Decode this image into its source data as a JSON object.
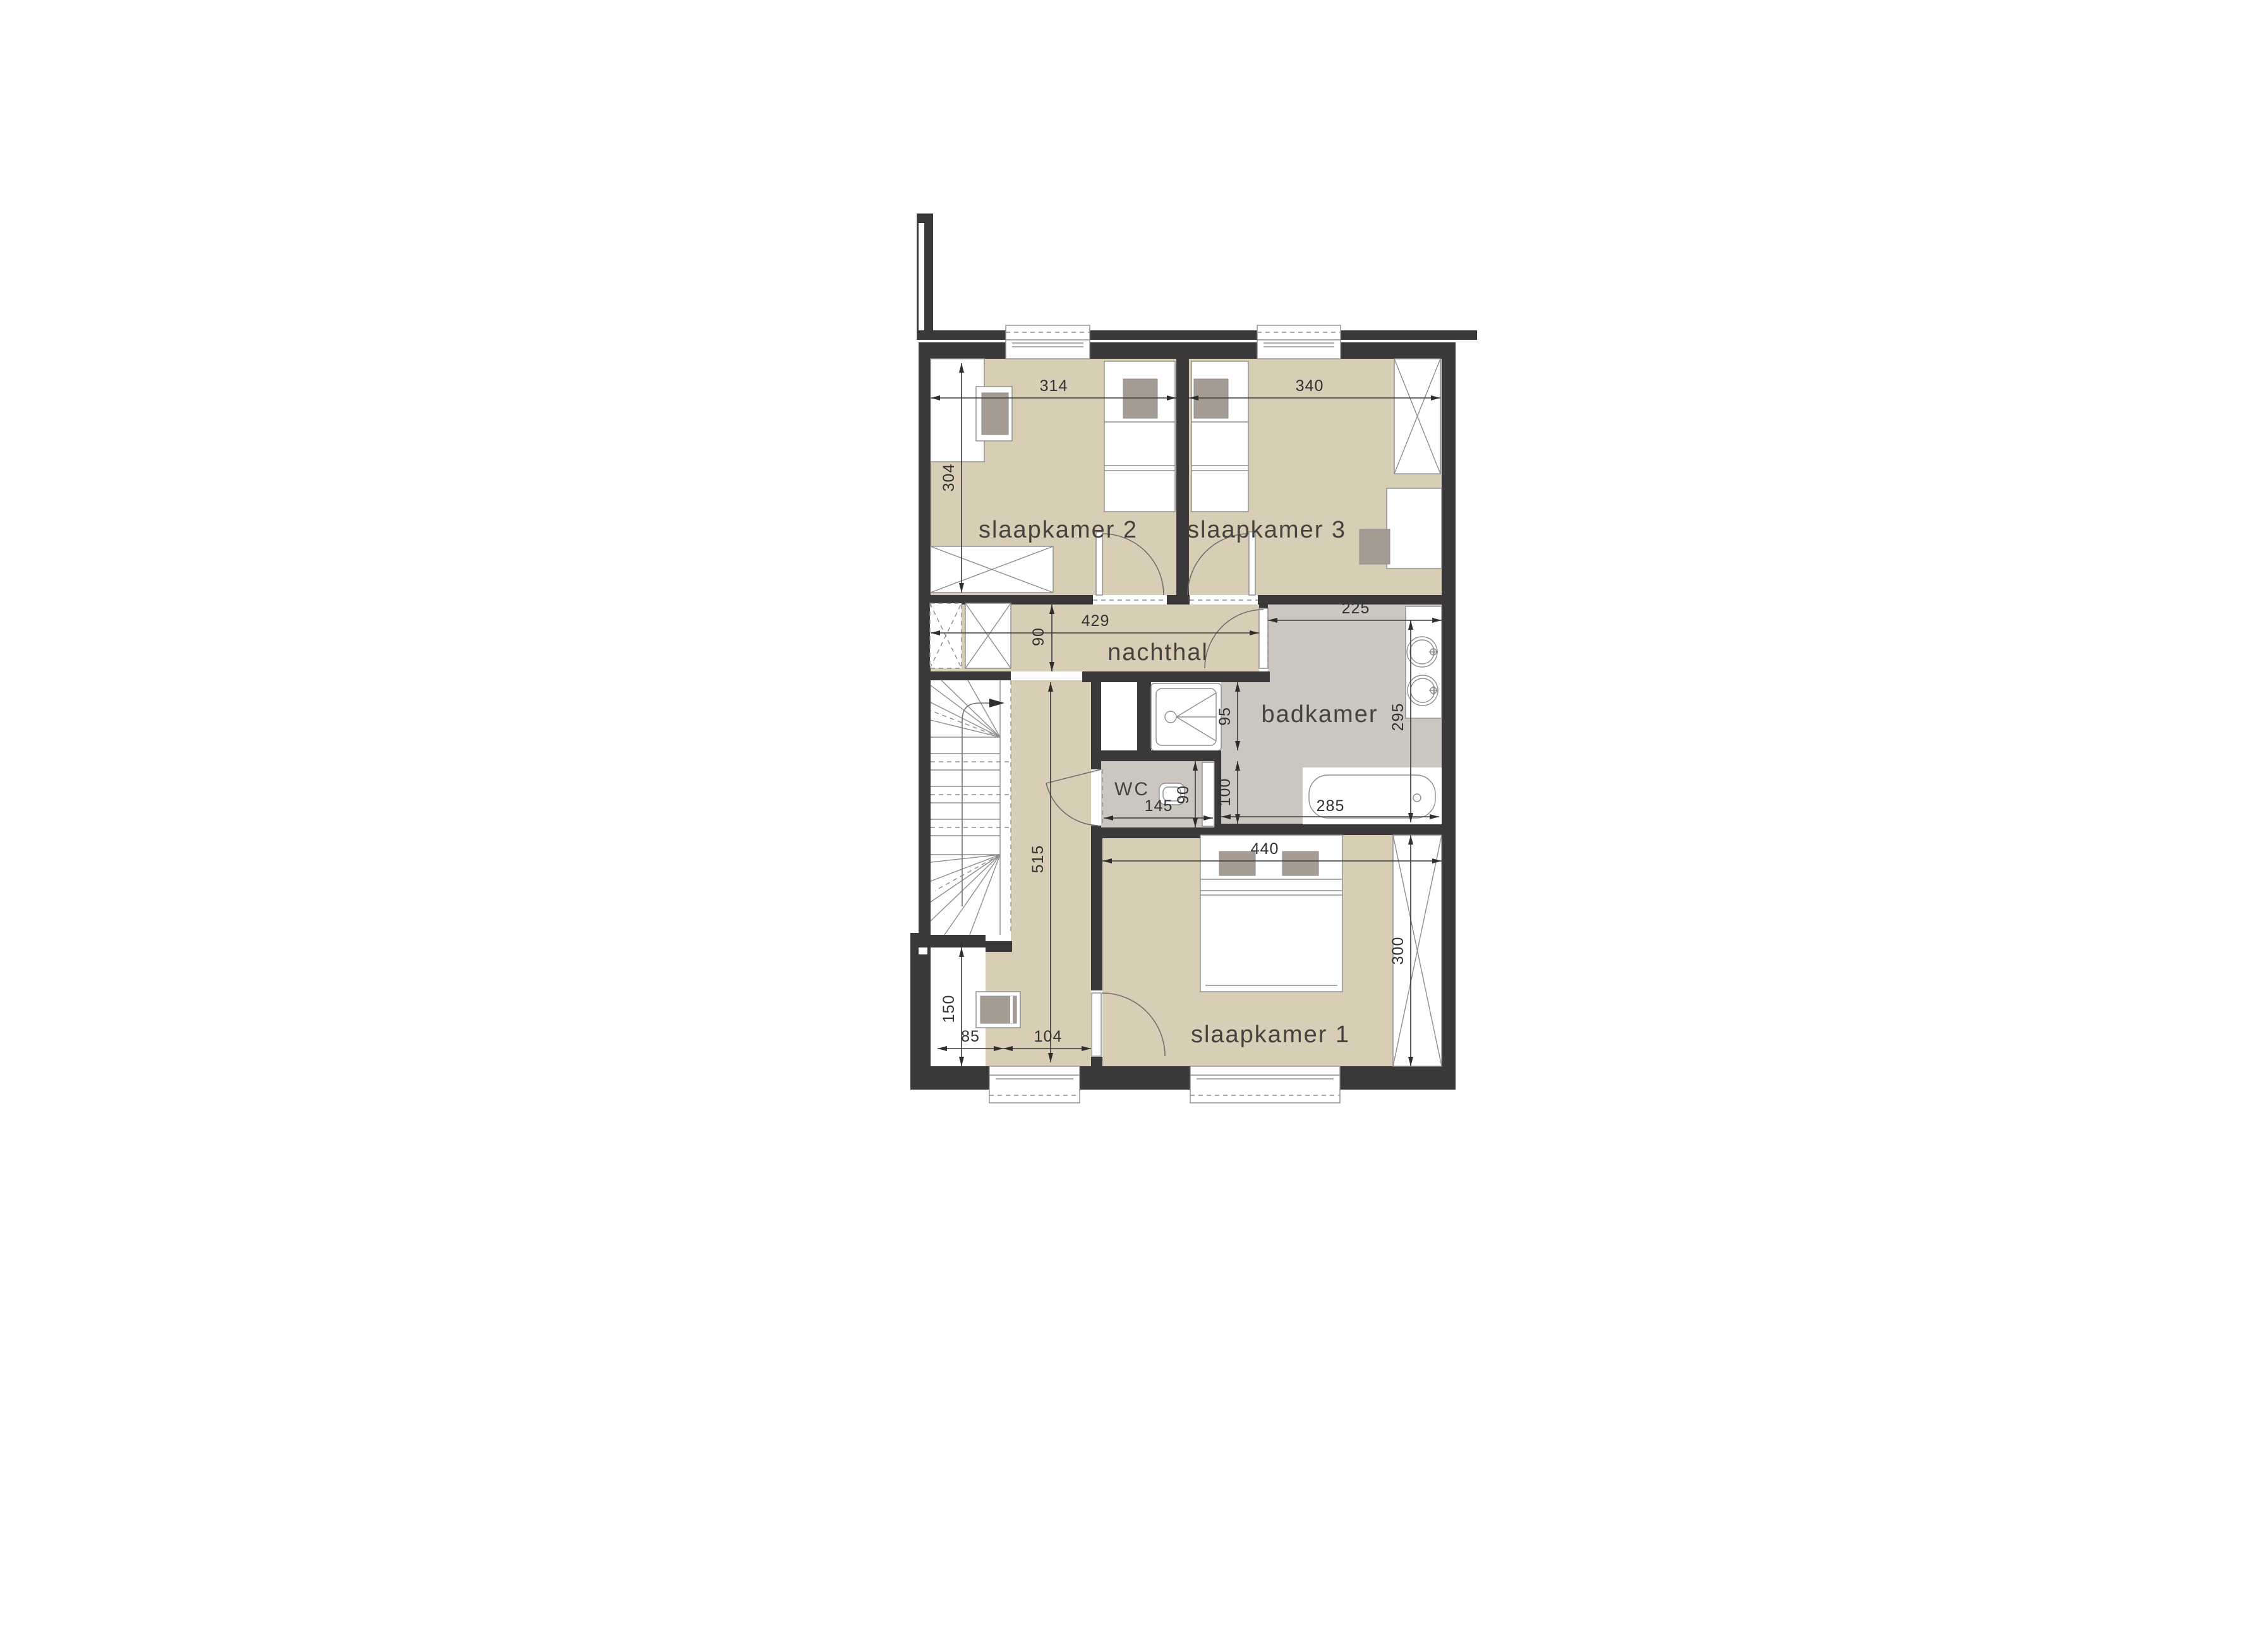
{
  "plan": {
    "type": "architectural floor plan, upper storey (verdieping)",
    "language": "Dutch"
  },
  "rooms": {
    "slaapkamer2": "slaapkamer 2",
    "slaapkamer3": "slaapkamer 3",
    "nachthal": "nachthal",
    "badkamer": "badkamer",
    "wc": "WC",
    "slaapkamer1": "slaapkamer 1"
  },
  "dims": {
    "sk2_width": "314",
    "sk3_width": "340",
    "sk2_depth": "304",
    "nachthal_width": "429",
    "nachthal_depth": "90",
    "badkamer_width": "225",
    "badkamer_depth": "295",
    "shower_zone": "95",
    "wc_zone": "100",
    "wc_width": "145",
    "wc_depth": "90",
    "bath_length": "285",
    "sk1_width": "440",
    "sk1_depth": "300",
    "hall_length": "515",
    "niche_depth": "150",
    "niche_width": "85",
    "hall_bottom_width": "104"
  },
  "colors": {
    "wall": "#3a3839",
    "floor_rooms": "#d8ceb6",
    "floor_wet": "#ccc6c0",
    "furniture_fill": "#ffffff",
    "furniture_accent": "#a59c94",
    "dimension_text": "#323232"
  }
}
